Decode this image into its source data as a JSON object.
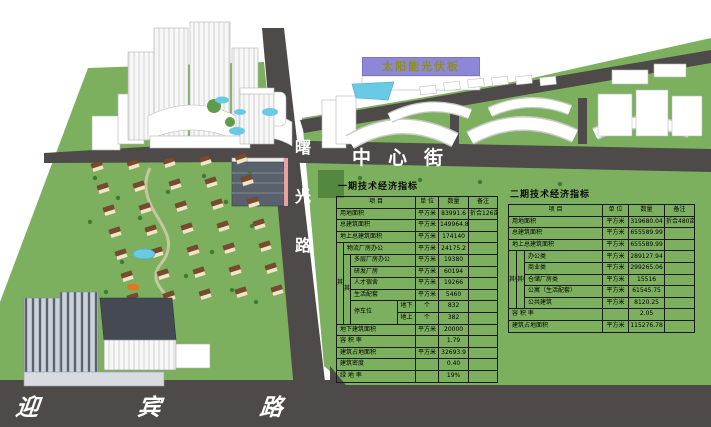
{
  "scene": {
    "labels": {
      "center_street": "中心街",
      "shuguang_road": "曙光路",
      "yingbin_road": "迎宾路",
      "solar_banner": "太阳能光伏板"
    },
    "colors": {
      "ground_green": "#7cb05e",
      "road_gray": "#4e4a4a",
      "water_blue": "#69cae6",
      "banner_purple": "#8e87d8",
      "banner_text_olive": "#8b8f1f",
      "residential_roof_brown": "#7a4a2e",
      "building_white": "#ffffff",
      "road_label_white": "#ffffff"
    }
  },
  "tables": {
    "phase1": {
      "title": "一期技术经济指标",
      "col_widths": [
        7,
        7,
        47,
        18,
        23,
        30,
        29
      ],
      "rows": [
        [
          {
            "t": "项  目",
            "cs": 4,
            "k": "h"
          },
          {
            "t": "单 位",
            "k": "h"
          },
          {
            "t": "数量",
            "k": "h"
          },
          {
            "t": "备注",
            "k": "h"
          }
        ],
        [
          {
            "t": "用地面积",
            "cs": 4,
            "k": "i"
          },
          {
            "t": "平方米",
            "k": "u"
          },
          {
            "t": "83991.6",
            "k": "q"
          },
          {
            "t": "折合126亩",
            "k": "n"
          }
        ],
        [
          {
            "t": "总建筑面积",
            "cs": 4,
            "k": "i"
          },
          {
            "t": "平方米",
            "k": "u"
          },
          {
            "t": "149964.8",
            "k": "q"
          },
          {
            "t": "",
            "k": "n"
          }
        ],
        [
          {
            "t": "地上总建筑面积",
            "cs": 4,
            "k": "i"
          },
          {
            "t": "平方米",
            "k": "u"
          },
          {
            "t": "174140",
            "k": "q"
          },
          {
            "t": "",
            "k": "n"
          }
        ],
        [
          {
            "t": "其中",
            "rs": 7,
            "k": "g"
          },
          {
            "t": "物流厂房办公",
            "cs": 3,
            "k": "i"
          },
          {
            "t": "平方米",
            "k": "u"
          },
          {
            "t": "24175.2",
            "k": "q"
          },
          {
            "t": "",
            "k": "n"
          }
        ],
        [
          {
            "t": "其中",
            "rs": 6,
            "k": "g"
          },
          {
            "t": "多层厂房办公",
            "cs": 2,
            "k": "i"
          },
          {
            "t": "平方米",
            "k": "u"
          },
          {
            "t": "19380",
            "k": "q"
          },
          {
            "t": "",
            "k": "n"
          }
        ],
        [
          {
            "t": "研发厂房",
            "cs": 2,
            "k": "i"
          },
          {
            "t": "平方米",
            "k": "u"
          },
          {
            "t": "60194",
            "k": "q"
          },
          {
            "t": "",
            "k": "n"
          }
        ],
        [
          {
            "t": "人才宿舍",
            "cs": 2,
            "k": "i"
          },
          {
            "t": "平方米",
            "k": "u"
          },
          {
            "t": "19266",
            "k": "q"
          },
          {
            "t": "",
            "k": "n"
          }
        ],
        [
          {
            "t": "生活配套",
            "cs": 2,
            "k": "i"
          },
          {
            "t": "平方米",
            "k": "u"
          },
          {
            "t": "5460",
            "k": "q"
          },
          {
            "t": "",
            "k": "n"
          }
        ],
        [
          {
            "t": "停车位",
            "rs": 2,
            "k": "i"
          },
          {
            "t": "地下",
            "k": "s"
          },
          {
            "t": "个",
            "k": "u"
          },
          {
            "t": "832",
            "k": "q"
          },
          {
            "t": "",
            "k": "n"
          }
        ],
        [
          {
            "t": "地上",
            "k": "s"
          },
          {
            "t": "个",
            "k": "u"
          },
          {
            "t": "382",
            "k": "q"
          },
          {
            "t": "",
            "k": "n"
          }
        ],
        [
          {
            "t": "地下建筑面积",
            "cs": 4,
            "k": "i"
          },
          {
            "t": "平方米",
            "k": "u"
          },
          {
            "t": "20000",
            "k": "q"
          },
          {
            "t": "",
            "k": "n"
          }
        ],
        [
          {
            "t": "容 积 率",
            "cs": 4,
            "k": "i"
          },
          {
            "t": "",
            "k": "u"
          },
          {
            "t": "1.79",
            "k": "q"
          },
          {
            "t": "",
            "k": "n"
          }
        ],
        [
          {
            "t": "建筑占地面积",
            "cs": 4,
            "k": "i"
          },
          {
            "t": "平方米",
            "k": "u"
          },
          {
            "t": "32693.9",
            "k": "q"
          },
          {
            "t": "",
            "k": "n"
          }
        ],
        [
          {
            "t": "建筑密度",
            "cs": 4,
            "k": "i"
          },
          {
            "t": "",
            "k": "u"
          },
          {
            "t": "0.40",
            "k": "q"
          },
          {
            "t": "",
            "k": "n"
          }
        ],
        [
          {
            "t": "绿 地 率",
            "cs": 4,
            "k": "i"
          },
          {
            "t": "",
            "k": "u"
          },
          {
            "t": "19%",
            "k": "q"
          },
          {
            "t": "",
            "k": "n"
          }
        ]
      ]
    },
    "phase2": {
      "title": "二期技术经济指标",
      "col_widths": [
        8,
        8,
        64,
        14,
        26,
        36,
        30
      ],
      "rows": [
        [
          {
            "t": "项  目",
            "cs": 4,
            "k": "h"
          },
          {
            "t": "单 位",
            "k": "h"
          },
          {
            "t": "数量",
            "k": "h"
          },
          {
            "t": "备注",
            "k": "h"
          }
        ],
        [
          {
            "t": "用地面积",
            "cs": 4,
            "k": "i"
          },
          {
            "t": "平方米",
            "k": "u"
          },
          {
            "t": "319680.04",
            "k": "q"
          },
          {
            "t": "折合480亩",
            "k": "n"
          }
        ],
        [
          {
            "t": "总建筑面积",
            "cs": 4,
            "k": "i"
          },
          {
            "t": "平方米",
            "k": "u"
          },
          {
            "t": "655589.99",
            "k": "q"
          },
          {
            "t": "",
            "k": "n"
          }
        ],
        [
          {
            "t": "地上总建筑面积",
            "cs": 4,
            "k": "i"
          },
          {
            "t": "平方米",
            "k": "u"
          },
          {
            "t": "655589.99",
            "k": "q"
          },
          {
            "t": "",
            "k": "n"
          }
        ],
        [
          {
            "t": "其中",
            "rs": 5,
            "k": "g"
          },
          {
            "t": "其中",
            "rs": 5,
            "k": "g"
          },
          {
            "t": "办公类",
            "cs": 2,
            "k": "i"
          },
          {
            "t": "平方米",
            "k": "u"
          },
          {
            "t": "289127.94",
            "k": "q"
          },
          {
            "t": "",
            "k": "n"
          }
        ],
        [
          {
            "t": "商业类",
            "cs": 2,
            "k": "i"
          },
          {
            "t": "平方米",
            "k": "u"
          },
          {
            "t": "299265.06",
            "k": "q"
          },
          {
            "t": "",
            "k": "n"
          }
        ],
        [
          {
            "t": "仓储厂房类",
            "cs": 2,
            "k": "i"
          },
          {
            "t": "平方米",
            "k": "u"
          },
          {
            "t": "15516",
            "k": "q"
          },
          {
            "t": "",
            "k": "n"
          }
        ],
        [
          {
            "t": "公寓（生活配套）",
            "cs": 2,
            "k": "i"
          },
          {
            "t": "平方米",
            "k": "u"
          },
          {
            "t": "61545.75",
            "k": "q"
          },
          {
            "t": "",
            "k": "n"
          }
        ],
        [
          {
            "t": "公共建筑",
            "cs": 2,
            "k": "i"
          },
          {
            "t": "平方米",
            "k": "u"
          },
          {
            "t": "8120.25",
            "k": "q"
          },
          {
            "t": "",
            "k": "n"
          }
        ],
        [
          {
            "t": "容 积 率",
            "cs": 4,
            "k": "i"
          },
          {
            "t": "",
            "k": "u"
          },
          {
            "t": "2.05",
            "k": "q"
          },
          {
            "t": "",
            "k": "n"
          }
        ],
        [
          {
            "t": "建筑占地面积",
            "cs": 4,
            "k": "i"
          },
          {
            "t": "平方米",
            "k": "u"
          },
          {
            "t": "115276.78",
            "k": "q"
          },
          {
            "t": "",
            "k": "n"
          }
        ]
      ]
    }
  }
}
